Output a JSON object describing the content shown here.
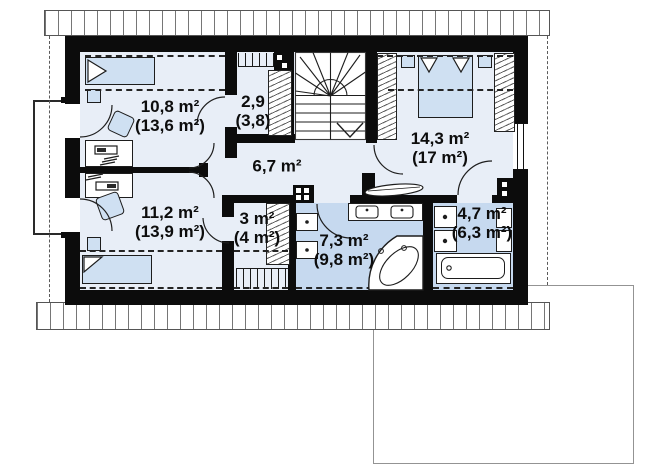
{
  "plan_title": "attic-floor-plan",
  "rooms": [
    {
      "name": "bedroom-1",
      "area": "10,8 m²",
      "area_gross": "(13,6 m²)"
    },
    {
      "name": "wardrobe-upper",
      "area": "2,9",
      "area_gross": "(3,8)"
    },
    {
      "name": "master-bedroom",
      "area": "14,3 m²",
      "area_gross": "(17 m²)"
    },
    {
      "name": "hallway",
      "area": "6,7 m²",
      "area_gross": ""
    },
    {
      "name": "bedroom-2",
      "area": "11,2 m²",
      "area_gross": "(13,9 m²)"
    },
    {
      "name": "closet",
      "area": "3 m²",
      "area_gross": "(4 m²)"
    },
    {
      "name": "bathroom",
      "area": "7,3 m²",
      "area_gross": "(9,8 m²)"
    },
    {
      "name": "bathroom-small",
      "area": "4,7 m²",
      "area_gross": "(6,3 m²)"
    }
  ],
  "colors": {
    "wall": "#0c0c0c",
    "floor": "#e8eef7",
    "wet_floor": "#c6d9ef",
    "furniture": "#cfe0f2",
    "roof_line": "#767676"
  }
}
